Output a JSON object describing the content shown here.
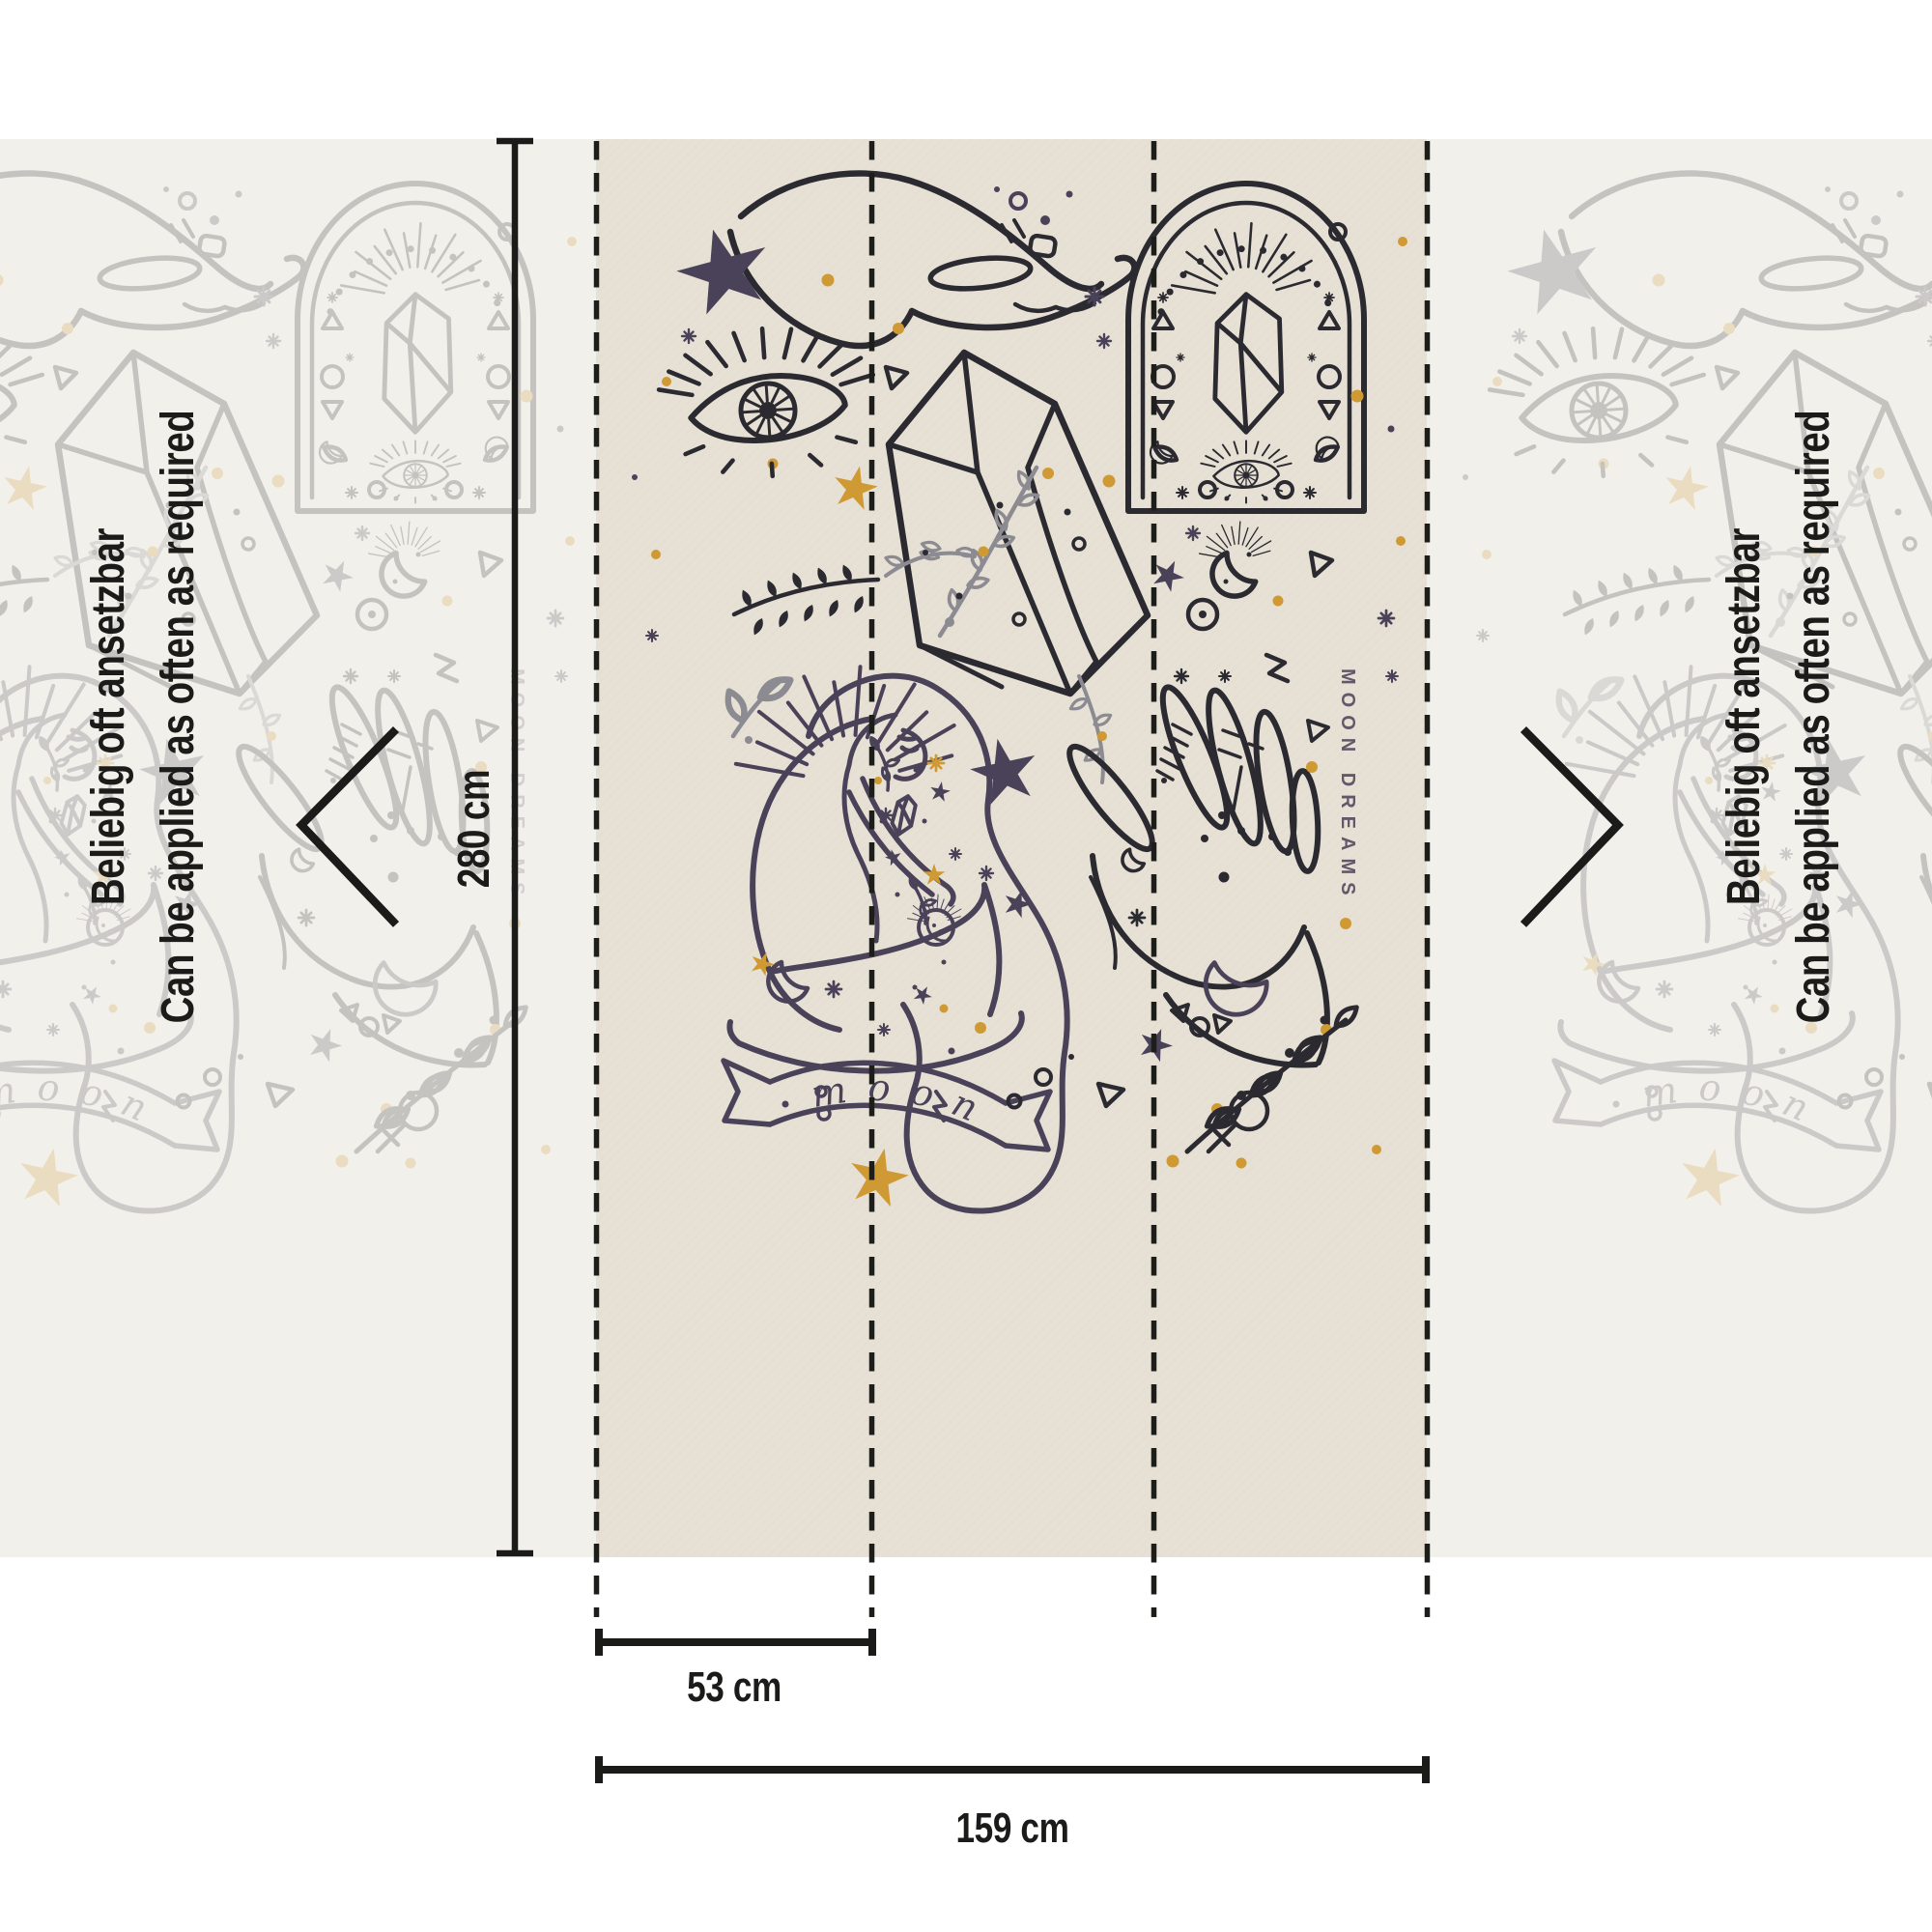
{
  "diagram": {
    "type": "wallpaper-strip-dimension-diagram",
    "measurements": {
      "height": "280 cm",
      "strip_width": "53 cm",
      "total_width": "159 cm"
    },
    "repeat_note": {
      "de": "Beliebig oft ansetzbar",
      "en": "Can be applied as often as required"
    },
    "strip_count_visible": 3,
    "seam_lines_visible": 4
  },
  "artwork": {
    "banner_word": "moon",
    "vertical_caption": "MOON DREAMS",
    "motifs": [
      "cupped-hand",
      "evil-eye",
      "crystal-prism-with-sprigs",
      "arch-window-with-crystal",
      "crouching-woman-with-halo",
      "open-palm-with-palmistry-marks",
      "crescent-moon",
      "scribble-stars",
      "ribbon-banner",
      "fern-branch"
    ]
  },
  "colors": {
    "ink": "#1b1b19",
    "beige": "#e7e1d5",
    "ghost_bg": "#f2f0ea",
    "art_dark": "#2c2a31",
    "art_navy": "#4a4258",
    "art_gray": "#8d8b92",
    "art_gold": "#cf9a33"
  }
}
